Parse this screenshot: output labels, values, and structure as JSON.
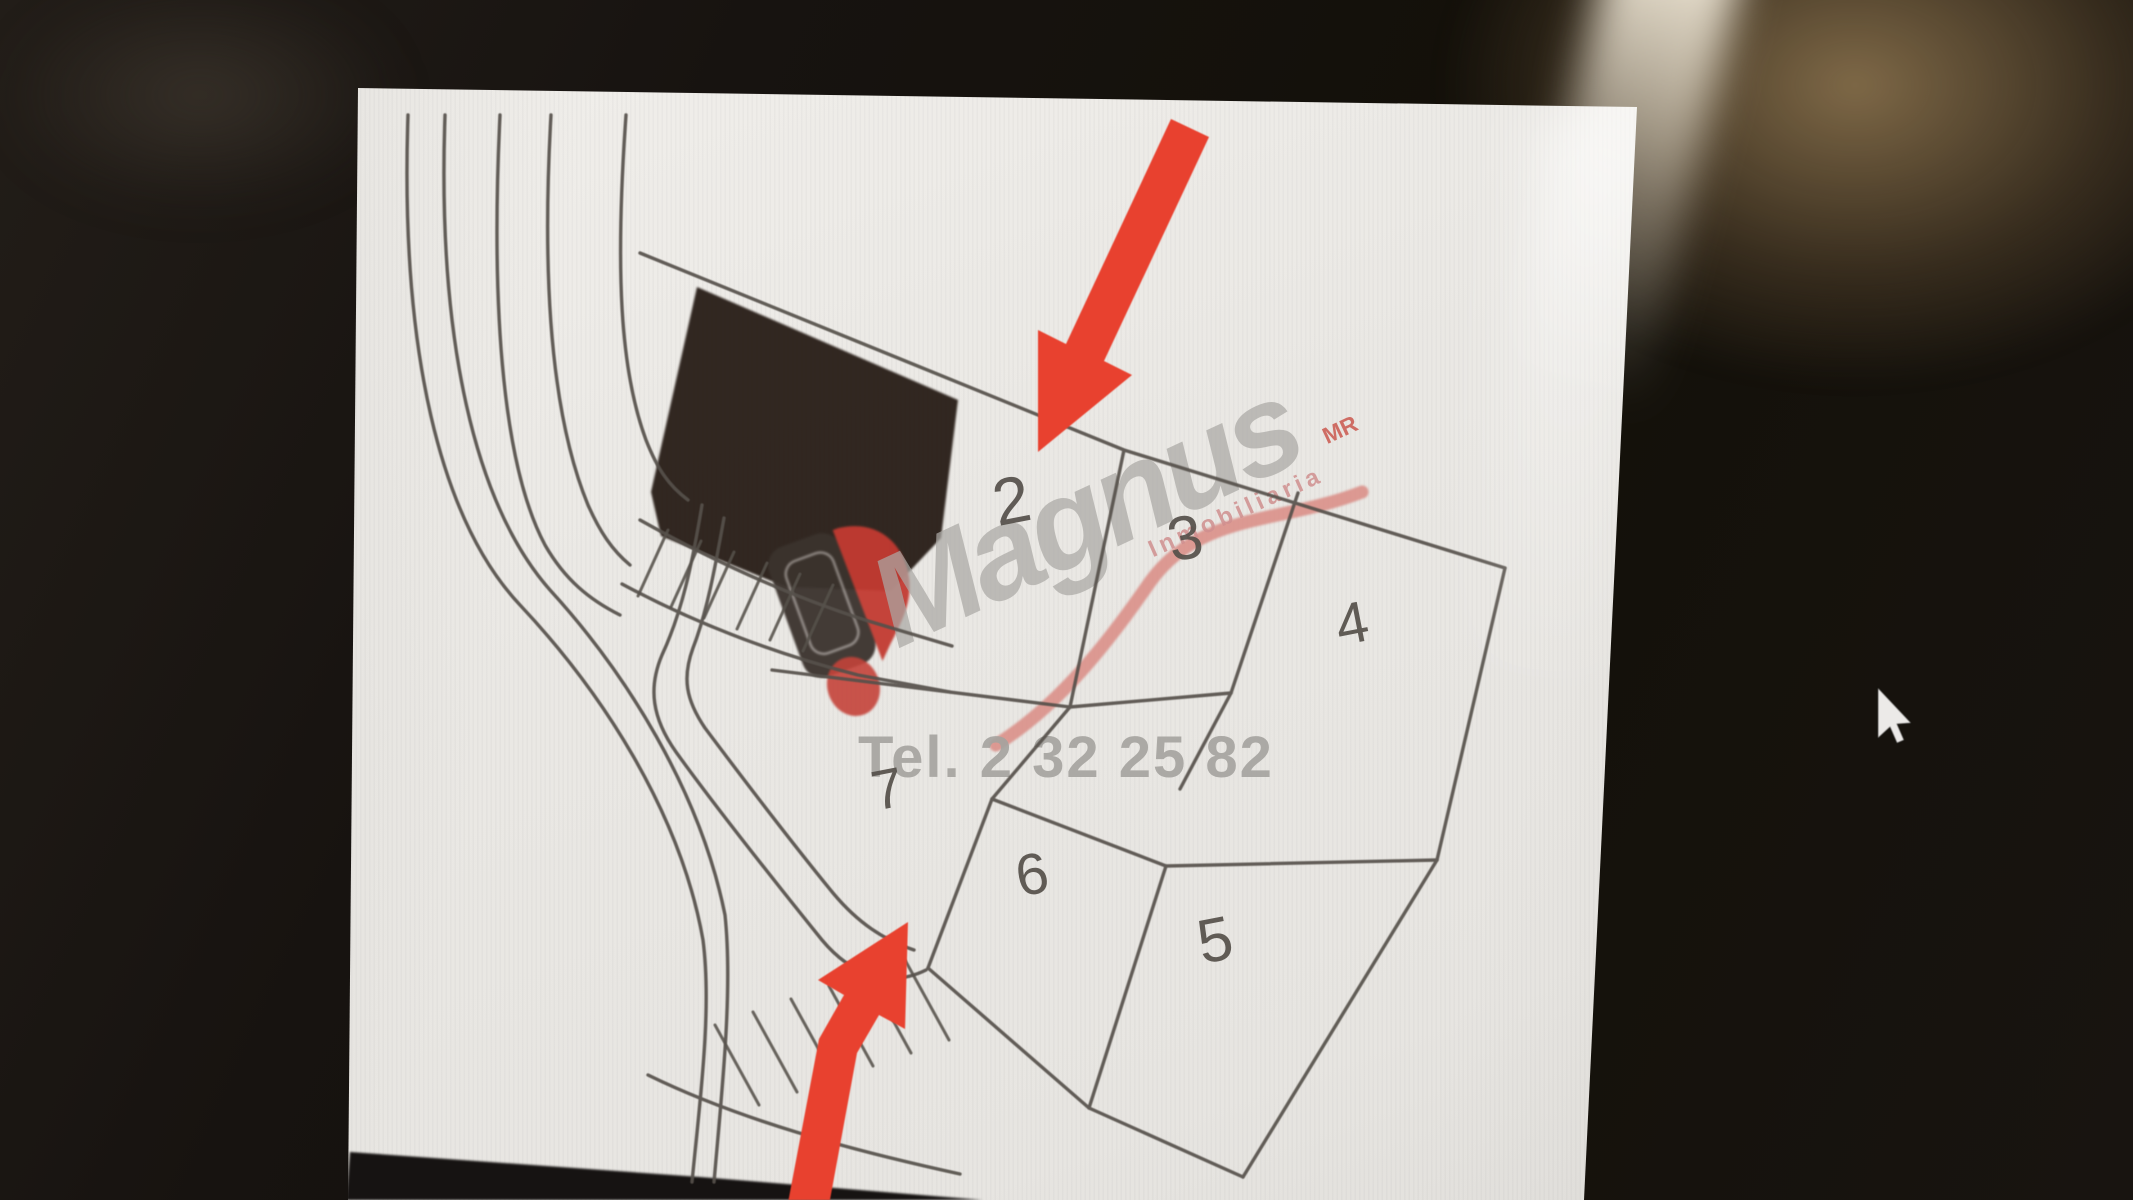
{
  "watermark": {
    "brand": "Magnus",
    "trademark_suffix": "MR",
    "tagline": "Inmobiliaria",
    "phone": "Tel. 2 32 25 82"
  },
  "plan": {
    "plot_labels": [
      "2",
      "3",
      "4",
      "5",
      "6",
      "7"
    ]
  },
  "annotations": {
    "arrow_color": "#e8412f"
  },
  "colors": {
    "page_white": "#ecebe7",
    "desktop_dark": "#16120f",
    "plan_line": "#56514b",
    "building_fill": "#2a201a",
    "brand_gray": "#aba9a5",
    "tagline_pink": "#d08f8f",
    "phone_gray": "#a5a39f",
    "swoosh_pink": "#d98b84",
    "logo_red": "#c23a31",
    "logo_dark": "#3a322d"
  },
  "icons": {
    "cursor": "arrow-pointer-icon",
    "logo": "location-pin-logo"
  }
}
